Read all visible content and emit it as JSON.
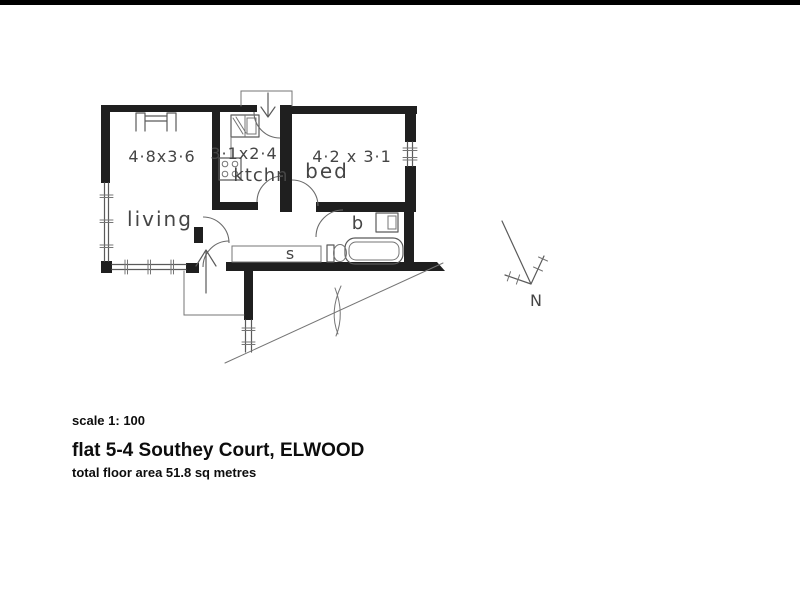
{
  "page": {
    "paper_color": "#ffffff",
    "top_bar_color": "#000000",
    "wall_color": "#1f1f1f",
    "ink_color": "#5a5a5a",
    "label_color": "#454545"
  },
  "plan": {
    "rooms": {
      "living": {
        "label": "living",
        "dims": "4·8x3·6"
      },
      "kitchen": {
        "label": "ktchn",
        "dims": "3·1x2·4"
      },
      "bed": {
        "label": "bed",
        "dims": "4·2 x 3·1"
      },
      "bath": {
        "label": "b"
      },
      "store": {
        "label": "s"
      }
    },
    "north_label": "N"
  },
  "footer": {
    "scale": "scale 1: 100",
    "title": "flat 5-4 Southey Court, ELWOOD",
    "area": "total floor area 51.8 sq metres"
  }
}
